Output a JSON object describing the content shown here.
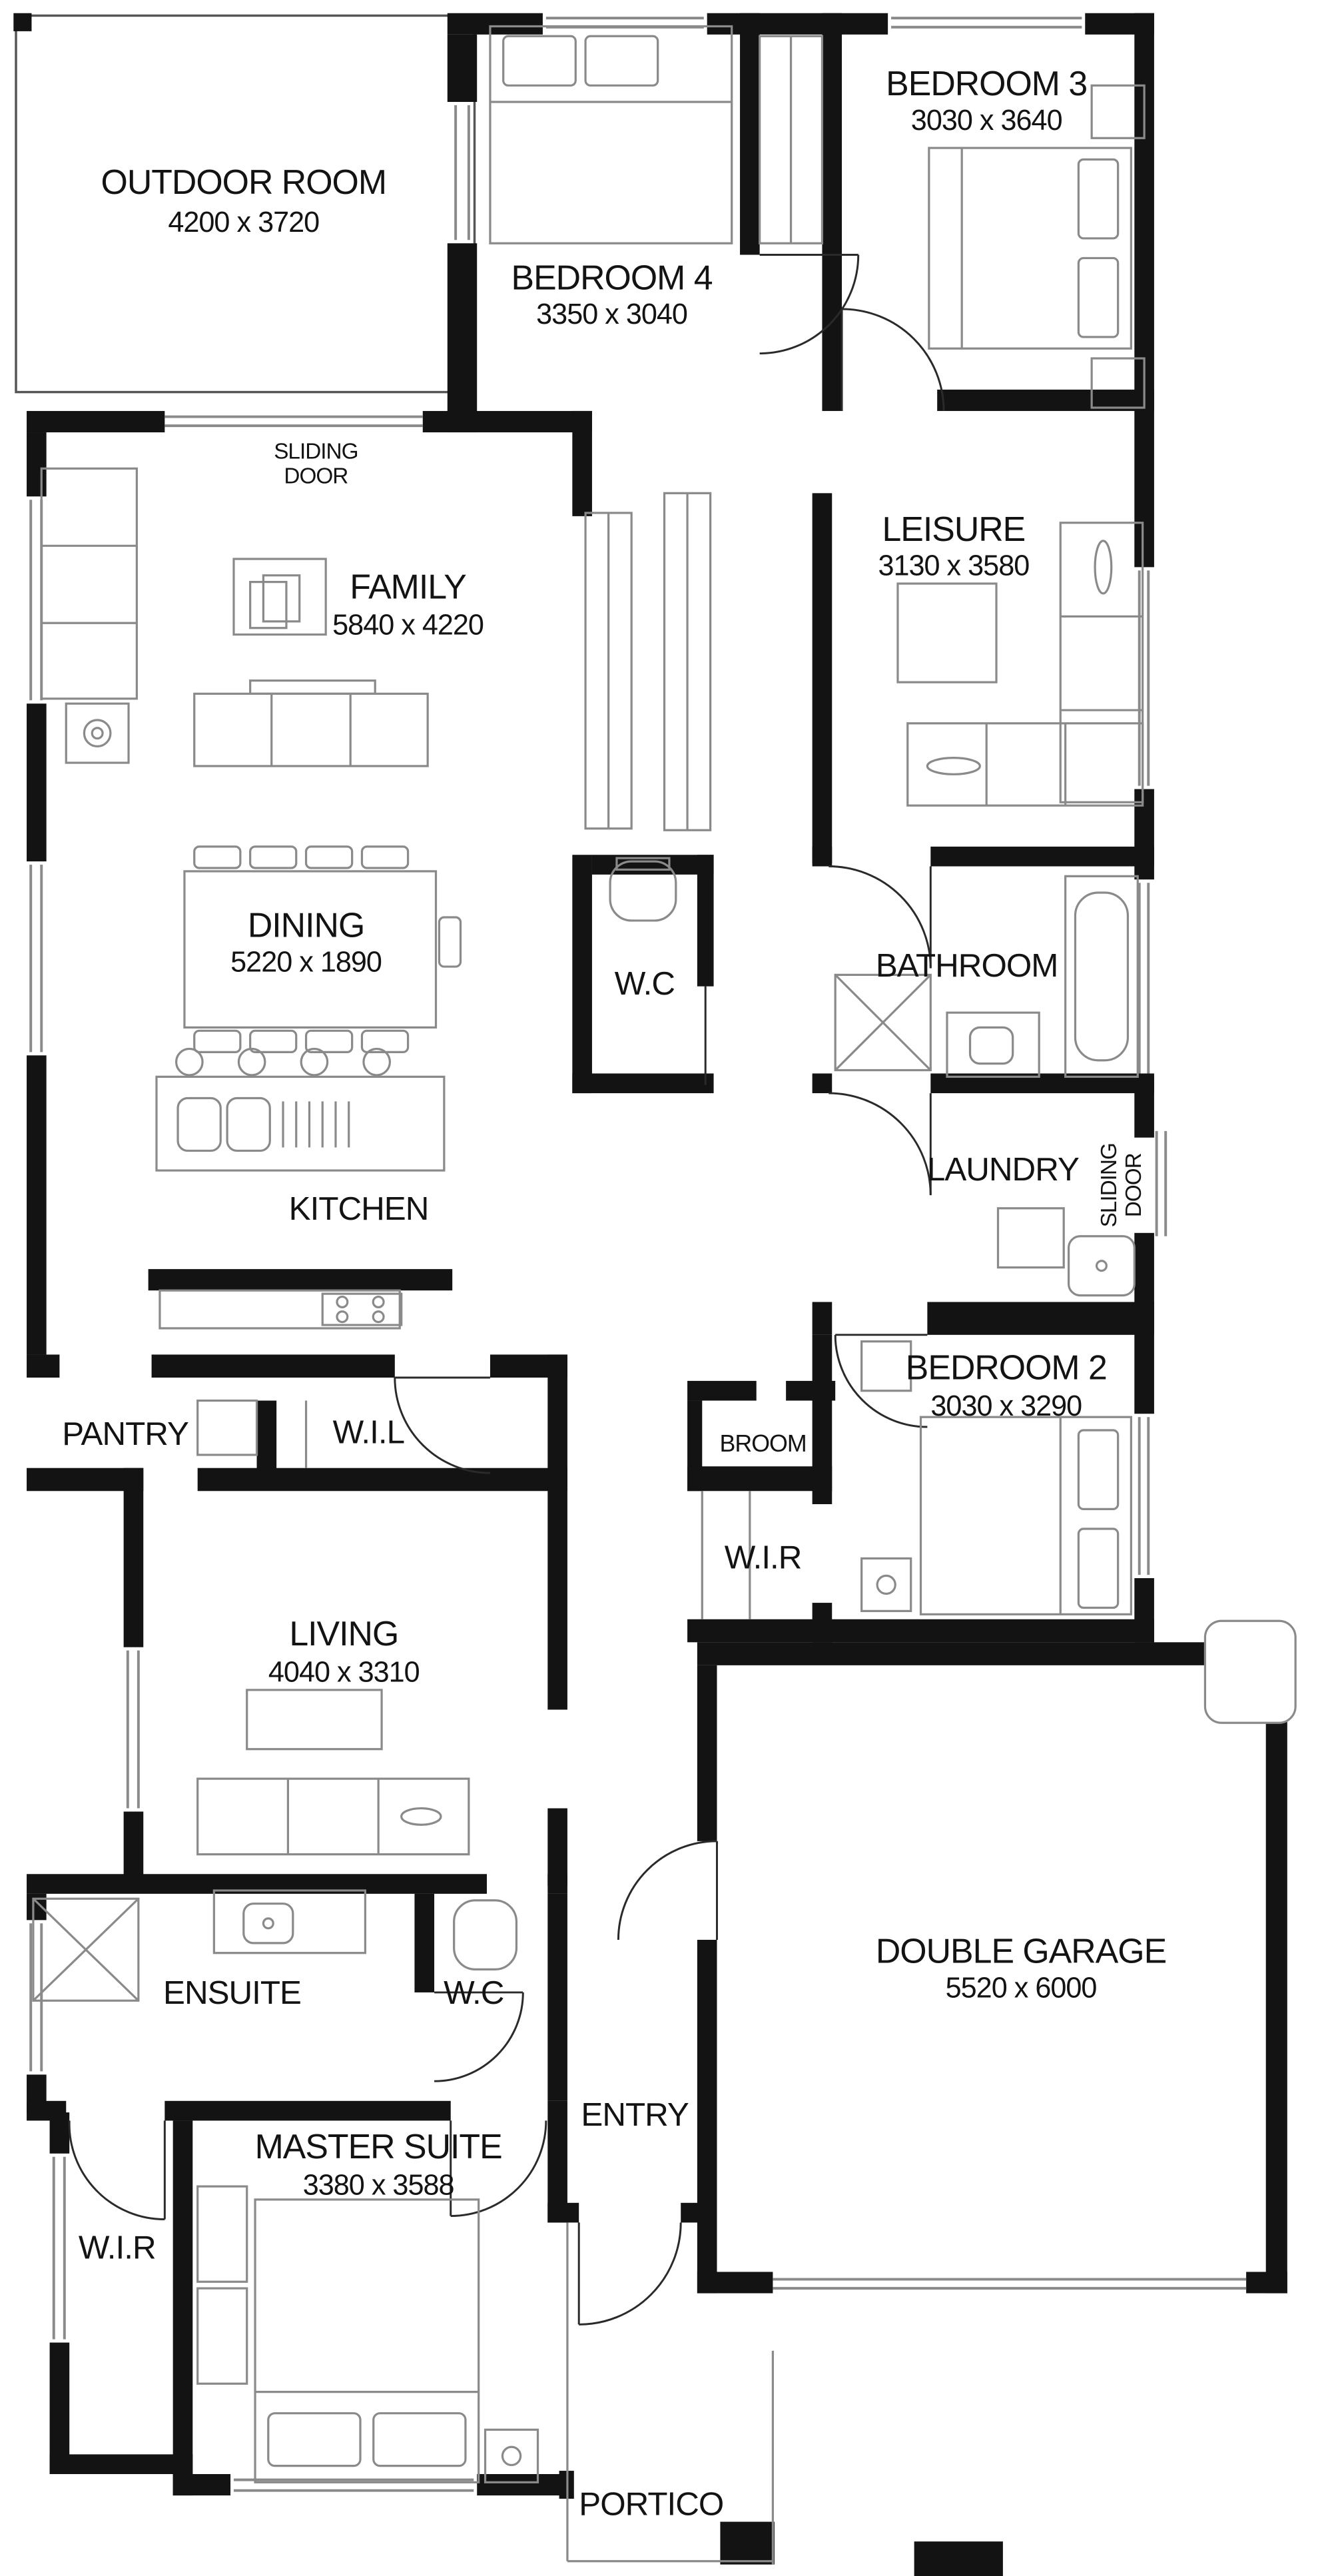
{
  "colors": {
    "wall": "#131313",
    "line": "#8a8a8a",
    "background": "#ffffff",
    "text": "#131313"
  },
  "rooms": {
    "outdoor": {
      "name": "OUTDOOR ROOM",
      "dims": "4200 x 3720"
    },
    "bed4": {
      "name": "BEDROOM 4",
      "dims": "3350 x 3040"
    },
    "bed3": {
      "name": "BEDROOM 3",
      "dims": "3030 x 3640"
    },
    "family": {
      "name": "FAMILY",
      "dims": "5840 x 4220"
    },
    "leisure": {
      "name": "LEISURE",
      "dims": "3130 x 3580"
    },
    "dining": {
      "name": "DINING",
      "dims": "5220 x 1890"
    },
    "wc_mid": {
      "name": "W.C"
    },
    "bathroom": {
      "name": "BATHROOM"
    },
    "kitchen": {
      "name": "KITCHEN"
    },
    "laundry": {
      "name": "LAUNDRY"
    },
    "pantry": {
      "name": "PANTRY"
    },
    "wil": {
      "name": "W.I.L"
    },
    "broom": {
      "name": "BROOM"
    },
    "wir_mid": {
      "name": "W.I.R"
    },
    "bed2": {
      "name": "BEDROOM 2",
      "dims": "3030 x 3290"
    },
    "living": {
      "name": "LIVING",
      "dims": "4040 x 3310"
    },
    "garage": {
      "name": "DOUBLE GARAGE",
      "dims": "5520 x 6000"
    },
    "ensuite": {
      "name": "ENSUITE"
    },
    "wc_bottom": {
      "name": "W.C"
    },
    "entry": {
      "name": "ENTRY"
    },
    "master": {
      "name": "MASTER SUITE",
      "dims": "3380 x 3588"
    },
    "wir_bottom": {
      "name": "W.I.R"
    },
    "portico": {
      "name": "PORTICO"
    }
  },
  "annotations": {
    "sliding_door_top": {
      "line1": "SLIDING",
      "line2": "DOOR"
    },
    "sliding_door_laundry": {
      "line1": "SLIDING",
      "line2": "DOOR"
    }
  }
}
